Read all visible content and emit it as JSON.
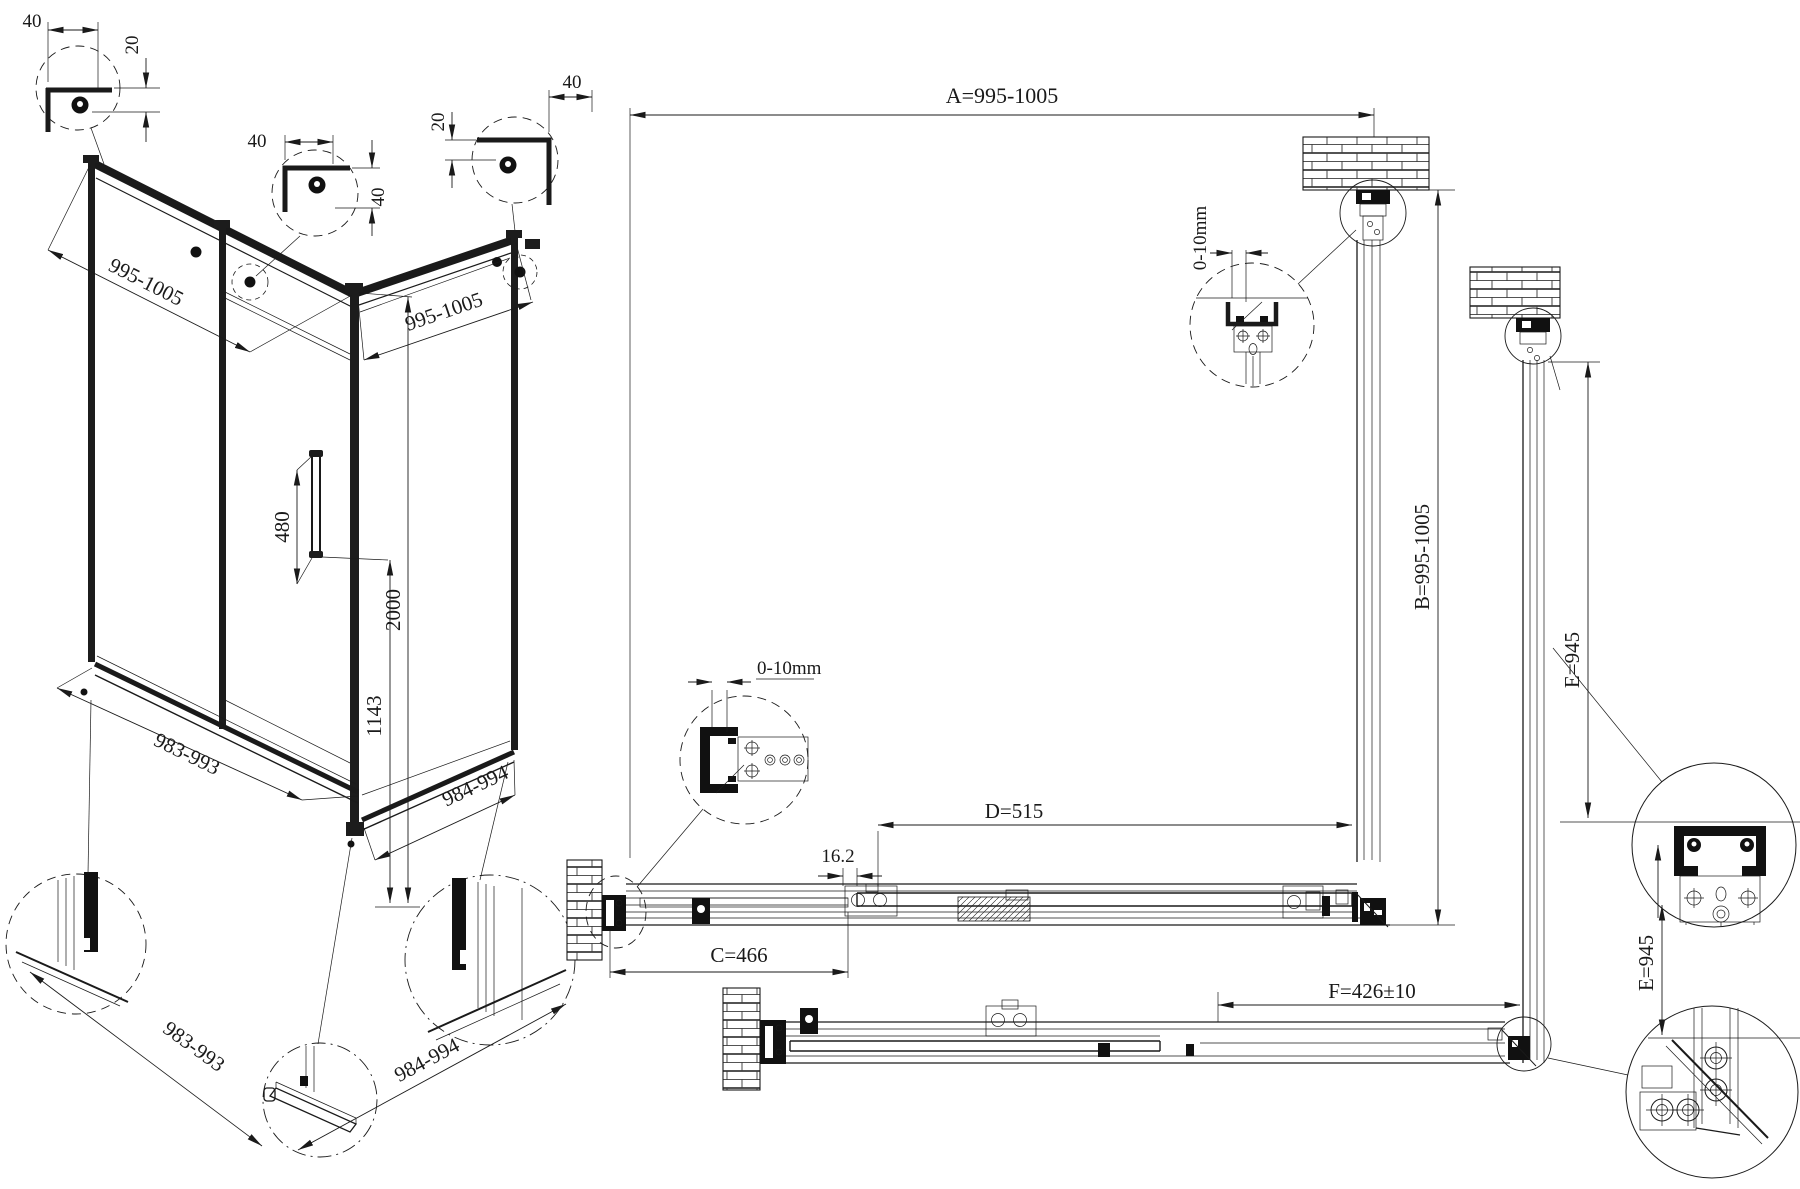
{
  "drawing": {
    "type": "shower-enclosure-installation-diagram",
    "labels": {
      "c1_w": "40",
      "c1_h": "20",
      "c2_w": "40",
      "c2_h": "40",
      "c3_h": "20",
      "c3_w": "40",
      "iso_front_width": "995-1005",
      "iso_side_width": "995-1005",
      "handle_length": "480",
      "total_height": "2000",
      "handle_height": "1143",
      "iso_bottom_front": "983-993",
      "iso_bottom_side": "984-994",
      "detail_bottom_front": "983-993",
      "detail_bottom_side": "984-994",
      "dim_a": "A=995-1005",
      "dim_b": "B=995-1005",
      "dim_c": "C=466",
      "dim_d": "D=515",
      "dim_f": "F=426±10",
      "dim_e_upper": "E=945",
      "dim_e_lower": "E=945",
      "overlap": "16.2",
      "wall_gap_left": "0-10mm",
      "wall_gap_top": "0-10mm"
    }
  }
}
